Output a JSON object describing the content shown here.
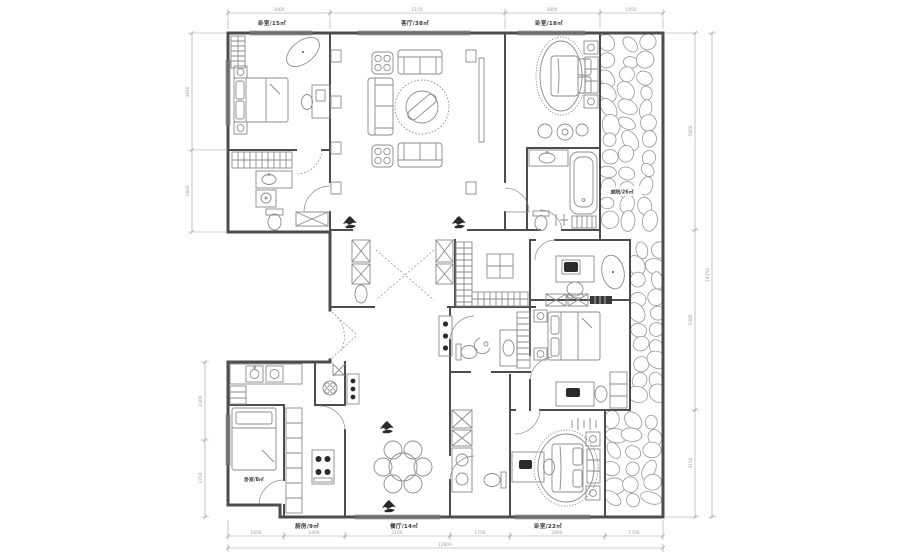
{
  "colors": {
    "wall": "#4d4d4d",
    "furniture": "#8b8b8b",
    "dim": "#9f9f9f",
    "label": "#383838",
    "stone": "#979797",
    "dark": "#2b2b2b"
  },
  "rooms": {
    "bedroom_top_left": "卧室/15㎡",
    "living": "客厅/38㎡",
    "bedroom_top_right": "卧室/18㎡",
    "garden": "庭院/26㎡",
    "maid_room": "卧室/8㎡",
    "kitchen": "厨房/9㎡",
    "dining": "餐厅/14㎡",
    "bedroom_bottom_right": "卧室/22㎡"
  },
  "dims": {
    "top": [
      "3000",
      "5150",
      "2800",
      "1850"
    ],
    "bottom": [
      "1650",
      "1800",
      "3100",
      "1750",
      "2800",
      "1700"
    ],
    "bottom_total": "12800",
    "left": [
      "3450",
      "2400"
    ],
    "left_lower": [
      "2300",
      "2250"
    ],
    "right": [
      "5800",
      "5300",
      "3150"
    ],
    "right_total": "14250"
  }
}
